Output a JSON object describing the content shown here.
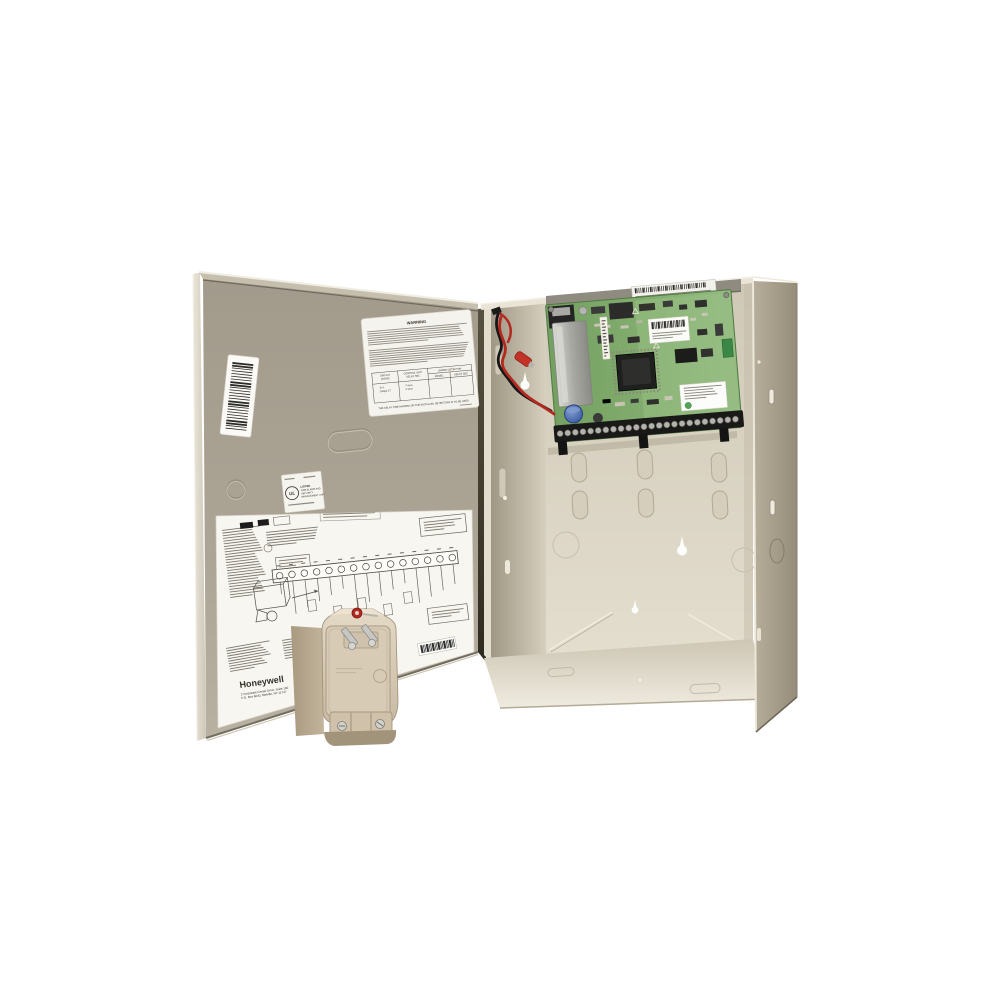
{
  "door": {
    "warning_label": {
      "title": "WARNING",
      "table": {
        "h_circuit_1": "CIRCUIT",
        "h_circuit_2": "(ZONE)",
        "h_control_1": "CONTROL UNIT",
        "h_control_2": "DELAY SEC",
        "h_smoke": "SMOKE DETECTOR",
        "h_model": "MODEL",
        "h_delay": "DELAY SEC",
        "r_circuit_1": "Zn 1",
        "r_circuit_2": "Output 17",
        "r_delay_1": "7 secs",
        "r_delay_2": "3 secs"
      },
      "note": "THE DELAY TIME MARKED ON THE INSTALLED DETECTORS IS TO BE USED"
    },
    "ul_label": {
      "mark": "UL",
      "line_1": "LISTED",
      "line_2": "FIRE ALARM AND",
      "line_3": "SECURITY",
      "line_4": "MANAGEMENT UNIT"
    },
    "wiring_label": {
      "brand": "Honeywell",
      "address_1": "2 Corporate Center Drive, Suite 100",
      "address_2": "P.O. Box 9040, Melville, NY 11747"
    }
  },
  "colors": {
    "background": "#ffffff",
    "cabinet_beige": "#d8d2c2",
    "door_taupe": "#a89f90",
    "right_wall_tan": "#9a9180",
    "pcb_green": "#7ca868",
    "terminal_black": "#191918",
    "wire_red": "#b3291f",
    "wire_black": "#161616",
    "transformer_beige": "#d6c9b3",
    "label_white": "#f5f3ed",
    "screw_red": "#b3291f"
  }
}
